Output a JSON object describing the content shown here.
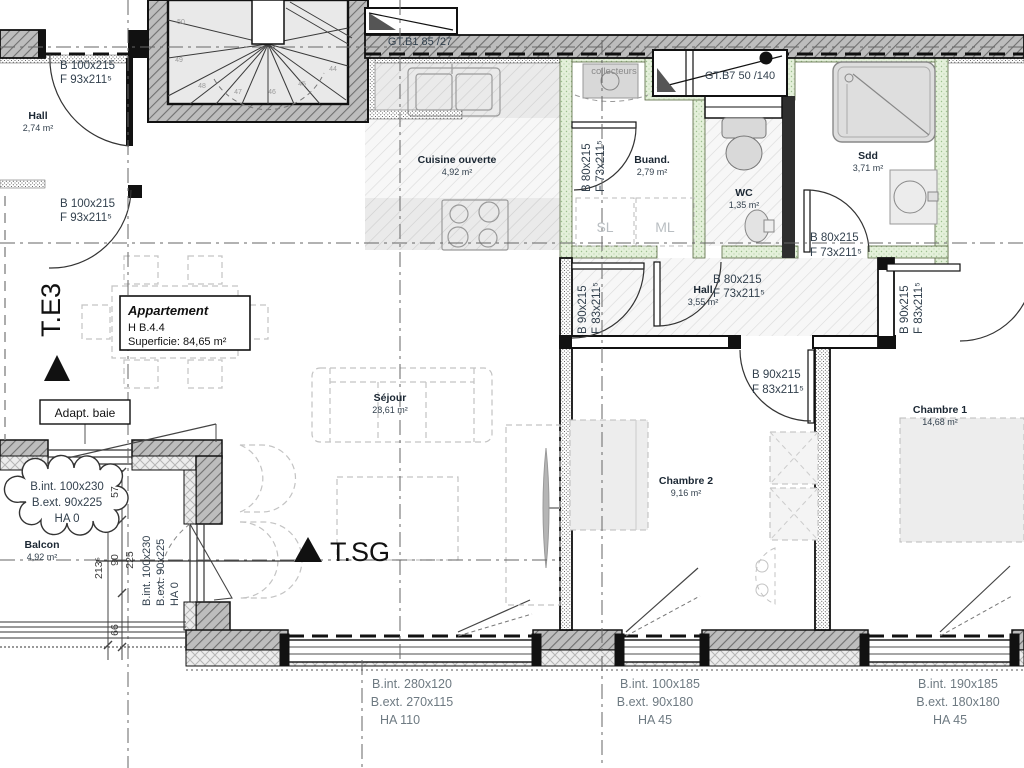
{
  "markers": {
    "te3": "T.E3",
    "tsg": "T.SG"
  },
  "title_box": {
    "name": "Appartement",
    "unit": "H B.4.4",
    "area": "Superficie: 84,65 m²"
  },
  "boxes": {
    "adapt_baie": "Adapt. baie"
  },
  "rooms": {
    "hall_entry": {
      "name": "Hall",
      "area": "2,74 m²"
    },
    "cuisine": {
      "name": "Cuisine ouverte",
      "area": "4,92 m²"
    },
    "buanderie": {
      "name": "Buand.",
      "area": "2,79 m²"
    },
    "wc": {
      "name": "WC",
      "area": "1,35 m²"
    },
    "sdd": {
      "name": "Sdd",
      "area": "3,71 m²"
    },
    "hall_night": {
      "name": "Hall",
      "area": "3,55 m²"
    },
    "sejour": {
      "name": "Séjour",
      "area": "28,61 m²"
    },
    "balcon": {
      "name": "Balcon",
      "area": "4,92 m²"
    },
    "chambre2": {
      "name": "Chambre 2",
      "area": "9,16 m²"
    },
    "chambre1": {
      "name": "Chambre 1",
      "area": "14,68 m²"
    }
  },
  "ducts": {
    "gtb1": "GT.B1  85 /27",
    "gtb7": "GT.B7  50 /140",
    "collecteurs": "collecteurs"
  },
  "appliances": {
    "sl": "SL",
    "ml": "ML"
  },
  "doors": {
    "entry_top": {
      "b": "B  100x215",
      "f": "F  93x211⁵"
    },
    "entry_bottom": {
      "b": "B  100x215",
      "f": "F  93x211⁵"
    },
    "buanderie": {
      "b": "B  80x215",
      "f": "F  73x211⁵"
    },
    "wc": {
      "b": "B  80x215",
      "f": "F  73x211⁵"
    },
    "sdd": {
      "b": "B  80x215",
      "f": "F  73x211⁵"
    },
    "sejour": {
      "b": "B  90x215",
      "f": "F  83x211⁵"
    },
    "chambre1": {
      "b": "B  90x215",
      "f": "F  83x211⁵"
    },
    "chambre2": {
      "b": "B  90x215",
      "f": "F  83x211⁵"
    }
  },
  "windows": {
    "sejour": {
      "l1": "B.int.  280x120",
      "l2": "B.ext.  270x115",
      "l3": "HA  110"
    },
    "chambre2": {
      "l1": "B.int.  100x185",
      "l2": "B.ext.  90x180",
      "l3": "HA  45"
    },
    "chambre1": {
      "l1": "B.int.  190x185",
      "l2": "B.ext.  180x180",
      "l3": "HA  45"
    },
    "balcon_cloud": {
      "l1": "B.int.  100x230",
      "l2": "B.ext.  90x225",
      "l3": "HA  0"
    },
    "balcon_side": {
      "l1": "B.int.  100x230",
      "l2": "B.ext.  90x225",
      "l3": "HA  0"
    }
  },
  "dimensions": {
    "d57": "57",
    "d90": "90",
    "d225": "225",
    "d2135": "213⁵",
    "d66": "66"
  },
  "stairs": {
    "steps": [
      "44",
      "45",
      "46",
      "47",
      "48",
      "49",
      "50"
    ]
  },
  "colors": {
    "wall_gray": "#bdbdbd",
    "green_wall": "#e4f0da",
    "label_blue": "#33414e",
    "window_label_gray": "#6e7a82"
  }
}
